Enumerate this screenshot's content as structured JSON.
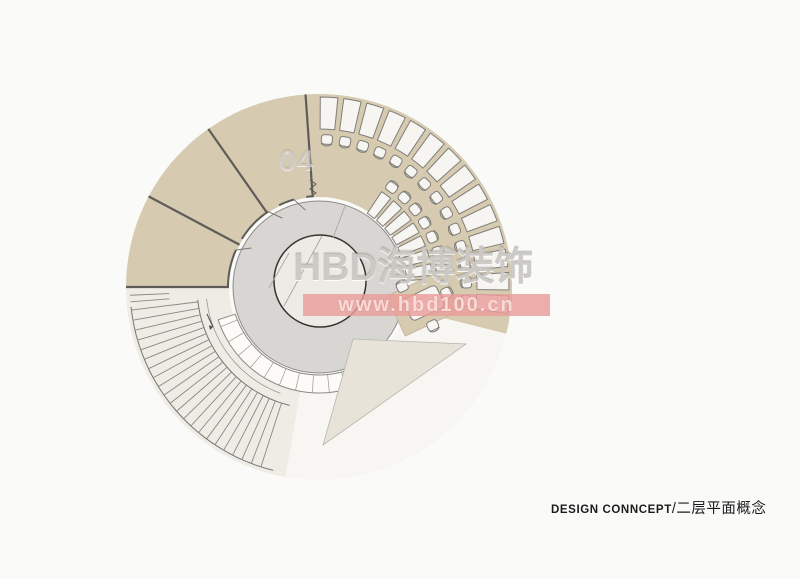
{
  "title_block": {
    "en": "DESIGN CONNCEPT",
    "zh": "/二层平面概念"
  },
  "watermark": {
    "number": "04",
    "brand": "HBD海博装饰",
    "url": "www.hbd100.cn",
    "band_color": "#e99d9a"
  },
  "grid": {
    "bubble_labels": [
      "3",
      "4",
      "5",
      "6",
      "7",
      "8",
      "9",
      "10",
      "11",
      "12",
      "13",
      "14",
      "15",
      "16",
      "17",
      "18",
      "19",
      null,
      "1",
      "2"
    ],
    "segment_dimension": "1549"
  },
  "rooms": {
    "office": {
      "name": "办公室",
      "seats": "13位",
      "area": "11.5m²"
    },
    "finance": {
      "name": "财务室",
      "area": "4.2m²"
    },
    "vip6": {
      "name": "VIP6",
      "area": "3.7m²"
    },
    "vip5": {
      "name": "VIP5",
      "area": "3.5m²"
    },
    "rest_area": {
      "name": "休息区"
    },
    "atrium_center": {
      "name": "中空"
    },
    "atrium_void": {
      "name": "中空"
    },
    "stair_direction": {
      "name": "下"
    }
  },
  "colors": {
    "background": "#fafaf8",
    "room_floor": "#d6cab0",
    "stair_floor": "#efece6",
    "void_floor": "#f8f6f2",
    "wedge": "#e8e3d9",
    "disk": "#d8d6d2",
    "atrium": "#edebe6",
    "wall_edge": "#8a8884",
    "wall_band": "#c2c0bb",
    "wall_block": "#4f4d4a",
    "furniture_fill": "#f7f5f1",
    "furniture_stroke": "#7f7d79",
    "column": "#0b0b0b",
    "dim_line": "#76746f",
    "label_dark": "#3e3c38",
    "label_soft": "#77756f"
  }
}
